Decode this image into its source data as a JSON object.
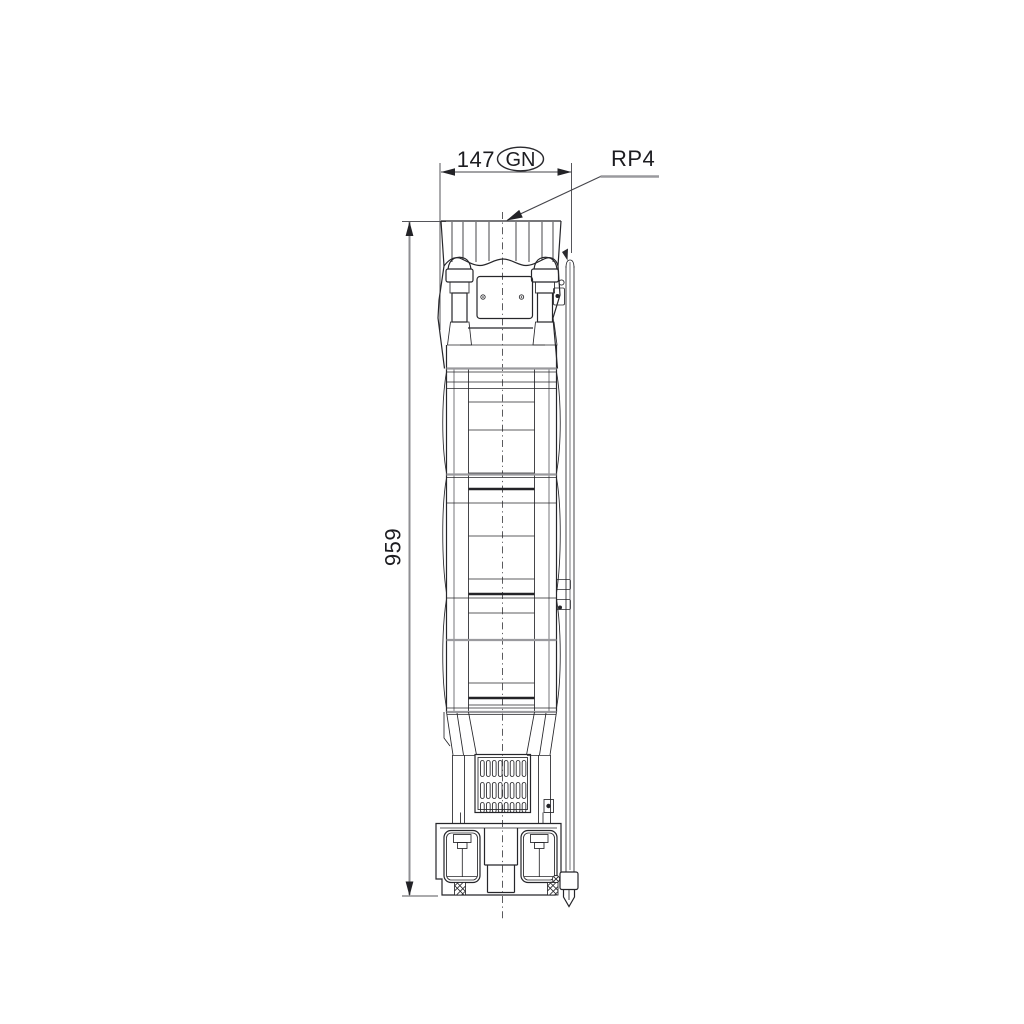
{
  "page": {
    "background": "#ffffff"
  },
  "dimensions": {
    "width": {
      "value": "147",
      "badge": "GN"
    },
    "height": {
      "value": "959"
    },
    "connection": {
      "label": "RP4"
    }
  },
  "colors": {
    "line": "#26262a",
    "gray_line": "#9a9a9e",
    "dimension_line": "#44444a",
    "text": "#1c1c20",
    "background": "#ffffff"
  }
}
